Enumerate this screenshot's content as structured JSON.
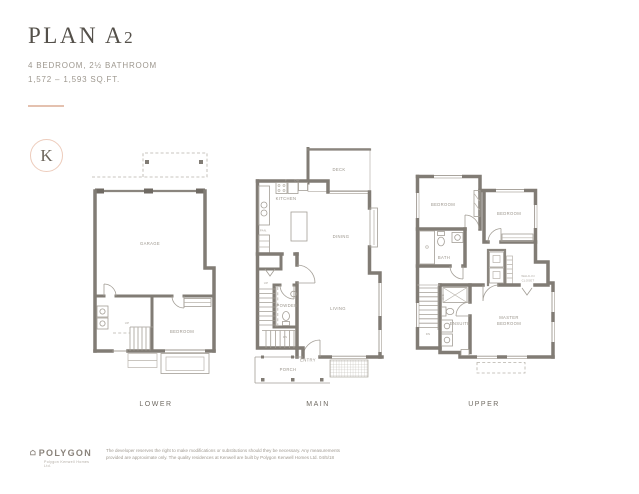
{
  "header": {
    "title_main": "PLAN A",
    "title_num": "2",
    "spec": "4 BEDROOM, 2½ BATHROOM",
    "area": "1,572 – 1,593 SQ.FT."
  },
  "brand": {
    "monogram": "K"
  },
  "floors": {
    "lower": {
      "label": "LOWER",
      "garage": "GARAGE",
      "bedroom": "BEDROOM",
      "up": "UP"
    },
    "main": {
      "label": "MAIN",
      "deck": "DECK",
      "kitchen": "KITCHEN",
      "dining": "DINING",
      "living": "LIVING",
      "powder": "POWDER",
      "pantry": "PAN.",
      "entry": "ENTRY",
      "porch": "PORCH",
      "fridge": "F",
      "dishwasher": "DW",
      "up": "UP",
      "dn": "DN"
    },
    "upper": {
      "label": "UPPER",
      "bedroom1": "BEDROOM",
      "bedroom2": "BEDROOM",
      "bath": "BATH",
      "ensuite": "ENSUITE",
      "master_line1": "MASTER",
      "master_line2": "BEDROOM",
      "walkin_line1": "WALK-IN",
      "walkin_line2": "CLOSET",
      "wd": "W/D",
      "dn": "DN"
    }
  },
  "footer": {
    "brand": "POLYGON",
    "tagline": "Polygon Kenwell Homes Ltd.",
    "disclaimer_line1": "The developer reserves the right to make modifications or substitutions should they be necessary. Any measurements",
    "disclaimer_line2": "provided are approximate only. The quality residences at Kenwell are built by Polygon Kenwell Homes Ltd. 04/5/18"
  }
}
